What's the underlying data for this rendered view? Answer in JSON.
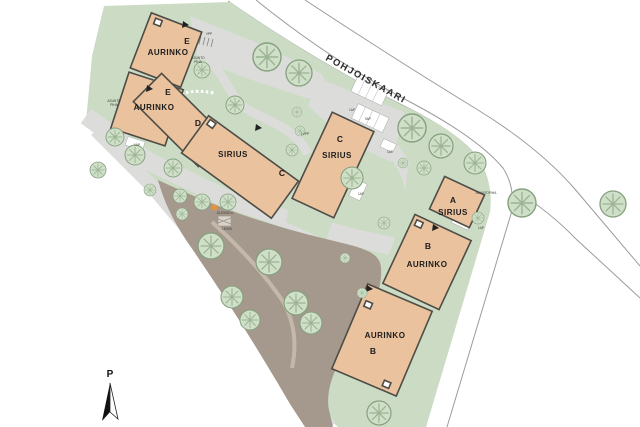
{
  "street": {
    "name": "POHJOISKAARI"
  },
  "north_arrow": {
    "label": "P"
  },
  "buildings": {
    "aurinko_e_top": {
      "letter": "E",
      "name": "AURINKO"
    },
    "aurinko_e_bottom": {
      "letter": "E",
      "name": "AURINKO"
    },
    "sirius_dc": {
      "letter_d": "D",
      "name": "SIRIUS",
      "letter_c": "C"
    },
    "sirius_c": {
      "letter": "C",
      "name": "SIRIUS"
    },
    "sirius_a": {
      "letter": "A",
      "name": "SIRIUS"
    },
    "aurinko_b_upper": {
      "letter": "B",
      "name": "AURINKO"
    },
    "aurinko_b_lower": {
      "name": "AURINKO",
      "letter": "B"
    }
  },
  "annotations": {
    "vpp": "VPP",
    "vpp1": "1VPP",
    "ap1": "1AP",
    "ap9": "9AP",
    "asunto": "ASUNTO",
    "piha": "PIHA",
    "asuntopiha": "ASUNTOPIHA",
    "oleskelu": "OLESKELU",
    "leikki": "LEIKKI"
  },
  "colors": {
    "building_fill": "#ebc29e",
    "building_outline": "#4d4d47",
    "green": "#cbdbc4",
    "path_gray": "#dcdddb",
    "ground_brown": "#a5988c",
    "tree_fill": "#cfdfc8",
    "tree_stroke": "#85a07e",
    "road_line": "#9b9b9b",
    "accent_orange": "#e2953f"
  }
}
